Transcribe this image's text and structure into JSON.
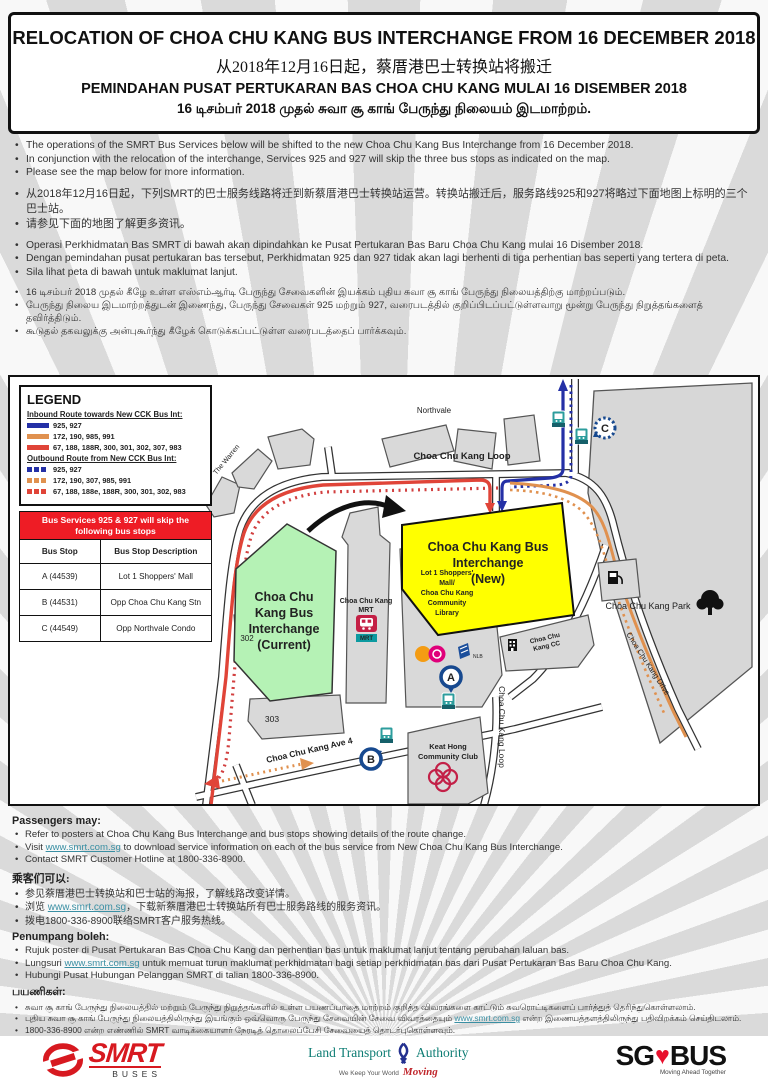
{
  "title": {
    "en": "RELOCATION OF CHOA CHU KANG BUS INTERCHANGE FROM 16 DECEMBER 2018",
    "zh": "从2018年12月16日起，蔡厝港巴士转换站将搬迁",
    "ms": "PEMINDAHAN PUSAT PERTUKARAN BAS CHOA CHU KANG MULAI 16 DISEMBER 2018",
    "ta": "16 டிசம்பர் 2018 முதல் சுவா சூ காங் பேருந்து நிலையம் இடமாற்றம்."
  },
  "intro": {
    "en": [
      "The operations of the SMRT Bus Services below will be shifted to the new Choa Chu Kang Bus Interchange from 16 December 2018.",
      "In conjunction with the relocation of the interchange, Services 925 and 927 will skip the three bus stops as indicated on the map.",
      "Please see the map below for more information."
    ],
    "zh": [
      "从2018年12月16日起，下列SMRT的巴士服务线路将迁到新蔡厝港巴士转换站运营。转换站搬迁后，服务路线925和927将略过下面地图上标明的三个巴士站。",
      "请参见下面的地图了解更多资讯。"
    ],
    "ms": [
      "Operasi Perkhidmatan Bas SMRT di bawah akan dipindahkan ke Pusat Pertukaran Bas Baru Choa Chu Kang mulai 16 Disember 2018.",
      "Dengan pemindahan pusat pertukaran bas tersebut, Perkhidmatan 925 dan 927 tidak akan lagi berhenti di tiga perhentian bas seperti yang tertera di peta.",
      "Sila lihat peta di bawah untuk maklumat lanjut."
    ],
    "ta": [
      "16 டிசம்பர் 2018 முதல் கீழே உள்ள எஸ்எம்ஆர்டி பேருந்து சேவைகளின் இயக்கம் புதிய சுவா சூ காங் பேருந்து நிலையத்திற்கு மாற்றப்படும்.",
      "பேருந்து நிலைய இடமாற்றத்துடன் இணைந்து, பேருந்து சேவைகள் 925 மற்றும் 927, வரைபடத்தில் குறிப்பிடப்பட்டுள்ளவாறு மூன்று பேருந்து நிறுத்தங்களைத் தவிர்த்திடும்.",
      "கூடுதல் தகவலுக்கு அன்புகூர்ந்து கீழேக் கொடுக்கப்பட்டுள்ள வரைபடத்தைப் பார்க்கவும்."
    ]
  },
  "legend": {
    "title": "LEGEND",
    "inbound_heading": "Inbound Route towards New CCK Bus Int:",
    "inbound": [
      {
        "routes": "925, 927",
        "color": "#2430a6"
      },
      {
        "routes": "172, 190, 985, 991",
        "color": "#e0914f"
      },
      {
        "routes": "67, 188, 188R, 300, 301, 302, 307, 983",
        "color": "#e04438"
      }
    ],
    "outbound_heading": "Outbound Route from New CCK Bus Int:",
    "outbound": [
      {
        "routes": "925, 927",
        "color": "#2430a6"
      },
      {
        "routes": "172, 190, 307, 985, 991",
        "color": "#e0914f"
      },
      {
        "routes": "67, 188, 188e, 188R, 300, 301, 302, 983",
        "color": "#e04438"
      }
    ]
  },
  "skip_table": {
    "header": "Bus Services 925 & 927 will skip the following bus stops",
    "col1": "Bus Stop",
    "col2": "Bus Stop Description",
    "rows": [
      {
        "stop": "A (44539)",
        "desc": "Lot 1 Shoppers' Mall"
      },
      {
        "stop": "B (44531)",
        "desc": "Opp Choa Chu Kang Stn"
      },
      {
        "stop": "C (44549)",
        "desc": "Opp Northvale Condo"
      }
    ]
  },
  "map": {
    "labels": {
      "northvale": "Northvale",
      "the_warren": "The Warren",
      "loop_top": "Choa Chu Kang Loop",
      "loop_right": "Choa Chu Kang Loop",
      "ave4": "Choa Chu Kang Ave 4",
      "drive": "Choa Chu Kang Drive",
      "park": "Choa Chu Kang Park",
      "current": [
        "Choa Chu",
        "Kang Bus",
        "Interchange",
        "(Current)"
      ],
      "new": [
        "Choa Chu Kang Bus",
        "Interchange",
        "(New)"
      ],
      "mrt": [
        "Choa Chu Kang",
        "MRT"
      ],
      "mrt_badge": "MRT",
      "lot1": [
        "Lot 1 Shoppers'",
        "Mall/",
        "Choa Chu Kang",
        "Community",
        "Library"
      ],
      "nlb": "NLB",
      "cc": [
        "Choa Chu",
        "Kang CC"
      ],
      "keat_hong": [
        "Keat Hong",
        "Community Club"
      ],
      "b302": "302",
      "b303": "303",
      "marker_a": "A",
      "marker_b": "B",
      "marker_c": "C"
    }
  },
  "passengers": {
    "en_heading": "Passengers may:",
    "en1": "Refer to posters at Choa Chu Kang Bus Interchange and bus stops showing details of the route change.",
    "en2": {
      "pre": "Visit ",
      "link": "www.smrt.com.sg",
      "post": " to download service information on each of the bus service from New Choa Chu Kang Bus Interchange."
    },
    "en3": "Contact SMRT Customer Hotline at 1800-336-8900.",
    "zh_heading": "乘客们可以:",
    "zh1": "参见蔡厝港巴士转换站和巴士站的海报，了解线路改变详情。",
    "zh2": {
      "pre": "浏览 ",
      "link": "www.smrt.com.sg",
      "post": "，下载新蔡厝港巴士转换站所有巴士服务路线的服务资讯。"
    },
    "zh3": "拨电1800-336-8900联络SMRT客户服务热线。",
    "ms_heading": "Penumpang boleh:",
    "ms1": "Rujuk poster di Pusat Pertukaran Bas Choa Chu Kang dan perhentian bas untuk maklumat lanjut tentang perubahan laluan bas.",
    "ms2": {
      "pre": "Lungsuri ",
      "link": "www.smrt.com.sg",
      "post": " untuk memuat turun maklumat perkhidmatan bagi setiap perkhidmatan bas dari Pusat Pertukaran Bas Baru Choa Chu Kang."
    },
    "ms3": "Hubungi Pusat Hubungan Pelanggan SMRT di talian 1800-336-8900.",
    "ta_heading": "பயணிகள்:",
    "ta1": "சுவா சூ காங் பேருந்து நிலையத்தில் மற்றும் பேருந்து நிறுத்தங்களில் உள்ள பயணப்பாதை மாற்றம் குறித்த விவரங்களை காட்டும் சுவரொட்டிகளைப் பார்த்துத் தெரிந்துகொள்ளலாம்.",
    "ta2": {
      "pre": "புதிய சுவா சூ காங் பேருந்து நிலையத்திலிருந்து இயங்கும் ஒவ்வொரு பேருந்து சேவையின் சேவை விவரத்தையும் ",
      "link": "www.smrt.com.sg",
      "post": " என்ற இணையத்தளத்திலிருந்து பதிவிறக்கம் செய்திடலாம்."
    },
    "ta3": "1800-336-8900 என்ற எண்ணில் SMRT வாடிக்கையாளர் நேரடித் தொலைப்பேசி சேவையைத் தொடர்புகொள்ளவும்."
  },
  "footer": {
    "smrt": "SMRT",
    "smrt_sub": "BUSES",
    "lta_left": "Land Transport",
    "lta_right": "Authority",
    "lta_tag": "We Keep Your World",
    "lta_tag_accent": "Moving",
    "sg": "SG",
    "bus": "BUS",
    "sgbus_sub": "Moving Ahead Together"
  },
  "colors": {
    "accent_red": "#ee1c25",
    "route_blue": "#2430a6",
    "route_orange": "#e0914f",
    "route_red": "#e04438",
    "interchange_current_green": "#b5f2b5",
    "interchange_new_yellow": "#ffff00",
    "bus_stop_teal": "#2d9d9d",
    "marker_blue": "#17498f",
    "link_teal": "#3a8fa3"
  }
}
